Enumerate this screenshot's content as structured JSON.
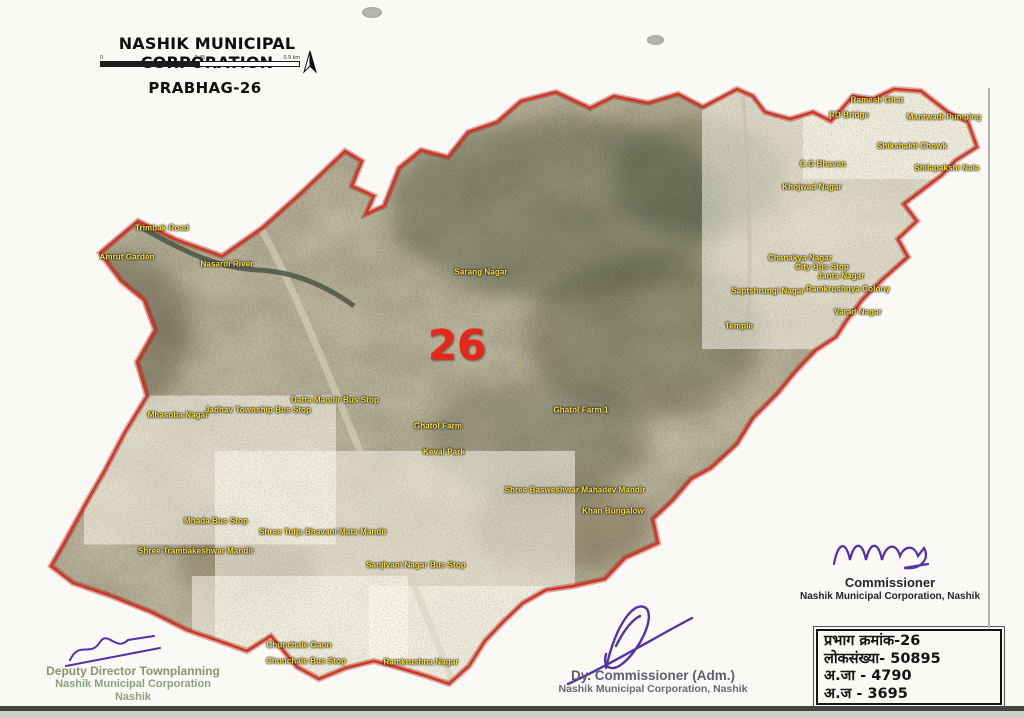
{
  "header": {
    "title": "NASHIK MUNICIPAL CORPORATION",
    "subtitle": "PRABHAG-26",
    "scale": {
      "start": "0",
      "mid": "0.45",
      "end": "0.9 km"
    }
  },
  "map": {
    "ward_number": "26",
    "ward_number_color": "#e8271b",
    "boundary_color": "#d63324",
    "label_color": "#ffe23e",
    "labels": [
      {
        "text": "Ramesh Ghat",
        "x": 877,
        "y": 100
      },
      {
        "text": "RD Bridge",
        "x": 849,
        "y": 115
      },
      {
        "text": "Mantwadi Pumping",
        "x": 944,
        "y": 117
      },
      {
        "text": "Shikshakti Chowk",
        "x": 912,
        "y": 146
      },
      {
        "text": "C.G Bhavan",
        "x": 823,
        "y": 164
      },
      {
        "text": "Shilapakshi Nale",
        "x": 947,
        "y": 168
      },
      {
        "text": "Khojwad Nagar",
        "x": 812,
        "y": 187
      },
      {
        "text": "Trimbak Road",
        "x": 162,
        "y": 228
      },
      {
        "text": "Amrut Garden",
        "x": 127,
        "y": 257
      },
      {
        "text": "Nasardi River",
        "x": 227,
        "y": 264
      },
      {
        "text": "Sarang Nagar",
        "x": 481,
        "y": 272
      },
      {
        "text": "Chanakya Nagar",
        "x": 800,
        "y": 258
      },
      {
        "text": "City Bus Stop",
        "x": 822,
        "y": 267
      },
      {
        "text": "Janta Nagar",
        "x": 841,
        "y": 276
      },
      {
        "text": "Ramkrushnya Colony",
        "x": 848,
        "y": 289
      },
      {
        "text": "Saptshrungi Nagar",
        "x": 768,
        "y": 291
      },
      {
        "text": "Varad Nagar",
        "x": 858,
        "y": 312
      },
      {
        "text": "Temple",
        "x": 739,
        "y": 326
      },
      {
        "text": "Mhasoba Nagar",
        "x": 178,
        "y": 415
      },
      {
        "text": "Jadhav Township Bus Stop",
        "x": 258,
        "y": 410
      },
      {
        "text": "Datta Mandir Bus Stop",
        "x": 335,
        "y": 400
      },
      {
        "text": "Ghatol Farm",
        "x": 438,
        "y": 426
      },
      {
        "text": "Ghatol Farm 1",
        "x": 581,
        "y": 410
      },
      {
        "text": "Keval Park",
        "x": 444,
        "y": 452
      },
      {
        "text": "Shree Basweshwar Mahadev Mandir",
        "x": 575,
        "y": 490
      },
      {
        "text": "Khan Bungalow",
        "x": 613,
        "y": 511
      },
      {
        "text": "Mhada Bus Stop",
        "x": 216,
        "y": 521
      },
      {
        "text": "Shree Tulja Bhavani Mata Mandir",
        "x": 323,
        "y": 532
      },
      {
        "text": "Shree Trambakeshwar Mandir",
        "x": 196,
        "y": 551
      },
      {
        "text": "Sanjivani Nagar Bus Stop",
        "x": 416,
        "y": 565
      },
      {
        "text": "Chunchale Gaon",
        "x": 299,
        "y": 645
      },
      {
        "text": "Chunchale Bus Stop",
        "x": 306,
        "y": 661
      },
      {
        "text": "Ramkrushna Nagar",
        "x": 421,
        "y": 662
      }
    ]
  },
  "signatures": {
    "left": {
      "line1": "Deputy Director Townplanning",
      "line2": "Nashik Municipal Corporation",
      "line3": "Nashik"
    },
    "center": {
      "line1": "Dy. Commissioner (Adm.)",
      "line2": "Nashik Municipal Corporation, Nashik"
    },
    "right": {
      "line1": "Commissioner",
      "line2": "Nashik Municipal Corporation, Nashik"
    }
  },
  "info_box": {
    "lines": [
      "प्रभाग क्रमांक-26",
      "लोकसंख्या- 50895",
      "अ.जा - 4790",
      "अ.ज -  3695"
    ]
  }
}
